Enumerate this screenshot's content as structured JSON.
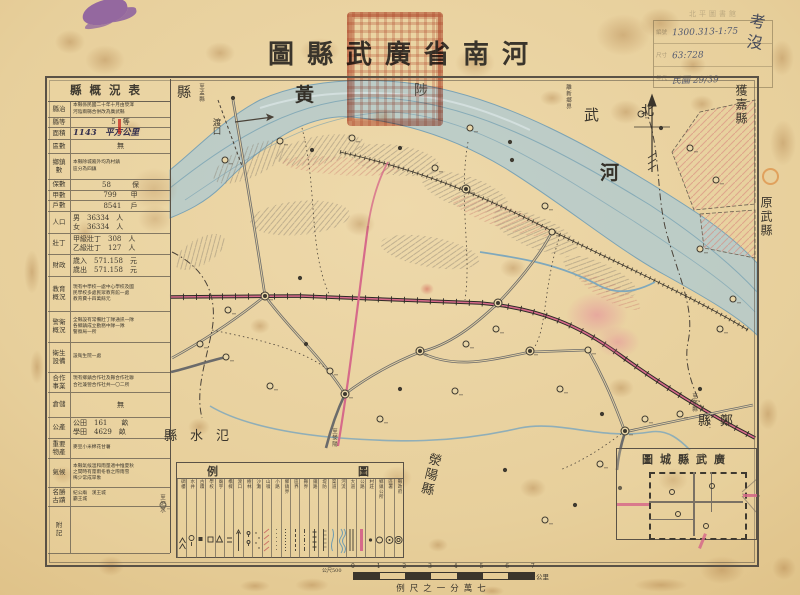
{
  "title": {
    "text": "圖縣武廣省南河"
  },
  "catalog": {
    "header": "北平圖書館",
    "rows": [
      {
        "label": "編號",
        "value": "1300.313-1:75"
      },
      {
        "label": "尺寸",
        "value": "63:728"
      },
      {
        "label": "年代",
        "value": "民國 29/39"
      }
    ],
    "handnote": "考\n沒"
  },
  "table": {
    "header": "縣概況表",
    "rows": [
      {
        "label": "縣治",
        "value": "本縣係民國二十年十月由滎澤\n河陰兩縣合併改為廣武縣",
        "cls": "sm"
      },
      {
        "label": "縣等",
        "value": "5　等",
        "cls": "ct"
      },
      {
        "label": "面積",
        "value": "1143　平方公里",
        "cls": "hand"
      },
      {
        "label": "區數",
        "value": "無",
        "cls": "ct"
      },
      {
        "label": "鄉鎮\n數",
        "value": "本縣除城廂外均為村鎮\n區分為四鎮",
        "cls": "sm"
      },
      {
        "label": "保數",
        "value": "58　　　保",
        "cls": "ct"
      },
      {
        "label": "甲數",
        "value": "799　　甲",
        "cls": "ct"
      },
      {
        "label": "戶數",
        "value": "8541　 戶",
        "cls": "ct"
      },
      {
        "label": "人口",
        "value": "男　36334　人\n女　36334　人"
      },
      {
        "label": "壯丁",
        "value": "甲級壯丁　308　人\n乙級壯丁　127　人"
      },
      {
        "label": "財政",
        "value": "歲入　571.158　元\n歲出　571.158　元"
      },
      {
        "label": "教育\n概況",
        "value": "現有中學校一處中心學校及國\n民學校多處民眾教育館一處\n教育費十四萬餘元",
        "cls": "sm"
      },
      {
        "label": "警衛\n概況",
        "value": "全縣設有常備壯丁隊通訊一隊\n各鄉鎮成立勤務中隊一隊\n警察局一所",
        "cls": "sm"
      },
      {
        "label": "衛生\n設備",
        "value": "設衛生院一處",
        "cls": "sm"
      },
      {
        "label": "合作\n事業",
        "value": "現有鄉鎮合作社及縣合作社聯\n合社兼營合作社共一〇二所",
        "cls": "sm"
      },
      {
        "label": "倉儲",
        "value": "無",
        "cls": "ct"
      },
      {
        "label": "公產",
        "value": "公田　161　　畝\n學田　4629　畝"
      },
      {
        "label": "重要\n物產",
        "value": "麥豆小米棉花甘薯",
        "cls": "sm"
      },
      {
        "label": "氣候",
        "value": "本縣氣候溫和雨量適中惟夏秋\n之間時有霪雨冬春之際雨雪\n稀少常成旱象",
        "cls": "sm"
      },
      {
        "label": "名勝\n古蹟",
        "value": "紀公廟　漢王城\n霸王城",
        "cls": "sm"
      },
      {
        "label": "附\n記",
        "value": ""
      }
    ]
  },
  "map": {
    "labels": {
      "north": "北",
      "huang": "黃",
      "he": "河",
      "wuzhi": [
        "縣",
        "陟",
        "武"
      ],
      "huojia": "獲嘉縣",
      "yuanwu": "原武縣",
      "zheng": "縣鄭",
      "fanshui": "縣水氾",
      "xingyang": "滎陽縣",
      "ferry": "渡口",
      "tomeng": "至孟縣",
      "lixinxiang": "離新鄉界",
      "toxingyang": "至滎陽",
      "tozheng": "至鄭縣",
      "tosishui": "至汜水"
    },
    "villages": [
      [
        233,
        98,
        0
      ],
      [
        225,
        160,
        1
      ],
      [
        280,
        141,
        1
      ],
      [
        312,
        150,
        0
      ],
      [
        352,
        138,
        1
      ],
      [
        400,
        148,
        0
      ],
      [
        435,
        168,
        1
      ],
      [
        466,
        189,
        2
      ],
      [
        470,
        128,
        1
      ],
      [
        510,
        142,
        0
      ],
      [
        545,
        206,
        1
      ],
      [
        512,
        160,
        0
      ],
      [
        265,
        296,
        2
      ],
      [
        300,
        278,
        0
      ],
      [
        228,
        310,
        1
      ],
      [
        200,
        344,
        1
      ],
      [
        226,
        357,
        1
      ],
      [
        270,
        386,
        1
      ],
      [
        306,
        344,
        0
      ],
      [
        330,
        371,
        1
      ],
      [
        345,
        394,
        2
      ],
      [
        380,
        419,
        1
      ],
      [
        400,
        389,
        0
      ],
      [
        420,
        351,
        2
      ],
      [
        455,
        391,
        1
      ],
      [
        466,
        344,
        1
      ],
      [
        496,
        329,
        1
      ],
      [
        530,
        351,
        2
      ],
      [
        560,
        389,
        1
      ],
      [
        588,
        350,
        1
      ],
      [
        602,
        414,
        0
      ],
      [
        625,
        431,
        2
      ],
      [
        600,
        464,
        1
      ],
      [
        620,
        488,
        0
      ],
      [
        645,
        419,
        1
      ],
      [
        680,
        414,
        1
      ],
      [
        700,
        389,
        0
      ],
      [
        720,
        329,
        1
      ],
      [
        733,
        299,
        1
      ],
      [
        700,
        249,
        1
      ],
      [
        716,
        180,
        1
      ],
      [
        690,
        148,
        1
      ],
      [
        661,
        128,
        0
      ],
      [
        641,
        114,
        1
      ],
      [
        552,
        232,
        1
      ],
      [
        498,
        303,
        2
      ],
      [
        545,
        520,
        1
      ],
      [
        505,
        470,
        0
      ],
      [
        575,
        505,
        0
      ],
      [
        163,
        505,
        1
      ]
    ]
  },
  "legend": {
    "title_left": "例",
    "title_right": "圖",
    "items": [
      {
        "name": "縣政府",
        "sym": "c2"
      },
      {
        "name": "區署",
        "sym": "cd"
      },
      {
        "name": "鄉鎮公所",
        "sym": "c0"
      },
      {
        "name": "村莊",
        "sym": "d"
      },
      {
        "name": "公路",
        "sym": "pk"
      },
      {
        "name": "大道",
        "sym": "db"
      },
      {
        "name": "河流",
        "sym": "wv"
      },
      {
        "name": "渠道",
        "sym": "bl"
      },
      {
        "name": "堤防",
        "sym": "tk"
      },
      {
        "name": "鐵路",
        "sym": "xx"
      },
      {
        "name": "縣界",
        "sym": "dd"
      },
      {
        "name": "區界",
        "sym": "ds"
      },
      {
        "name": "鄉鎮界",
        "sym": "dt"
      },
      {
        "name": "小路",
        "sym": "pt"
      },
      {
        "name": "山嶺",
        "sym": "hr"
      },
      {
        "name": "沙灘",
        "sym": "gr"
      },
      {
        "name": "樹林",
        "sym": "tr"
      },
      {
        "name": "渡口",
        "sym": "ar"
      },
      {
        "name": "橋樑",
        "sym": "eq"
      },
      {
        "name": "廟宇",
        "sym": "tri"
      },
      {
        "name": "學校",
        "sym": "sq"
      },
      {
        "name": "古蹟",
        "sym": "fl"
      },
      {
        "name": "水井",
        "sym": "wl"
      },
      {
        "name": "碉樓",
        "sym": "mt"
      }
    ]
  },
  "inset": {
    "title": "圖城縣武廣"
  },
  "scale": {
    "left_label": "公尺500",
    "right_label": "公里",
    "ticks": [
      "0",
      "1",
      "2",
      "3",
      "4",
      "5",
      "6",
      "7"
    ],
    "caption": "例尺之一分萬七"
  }
}
